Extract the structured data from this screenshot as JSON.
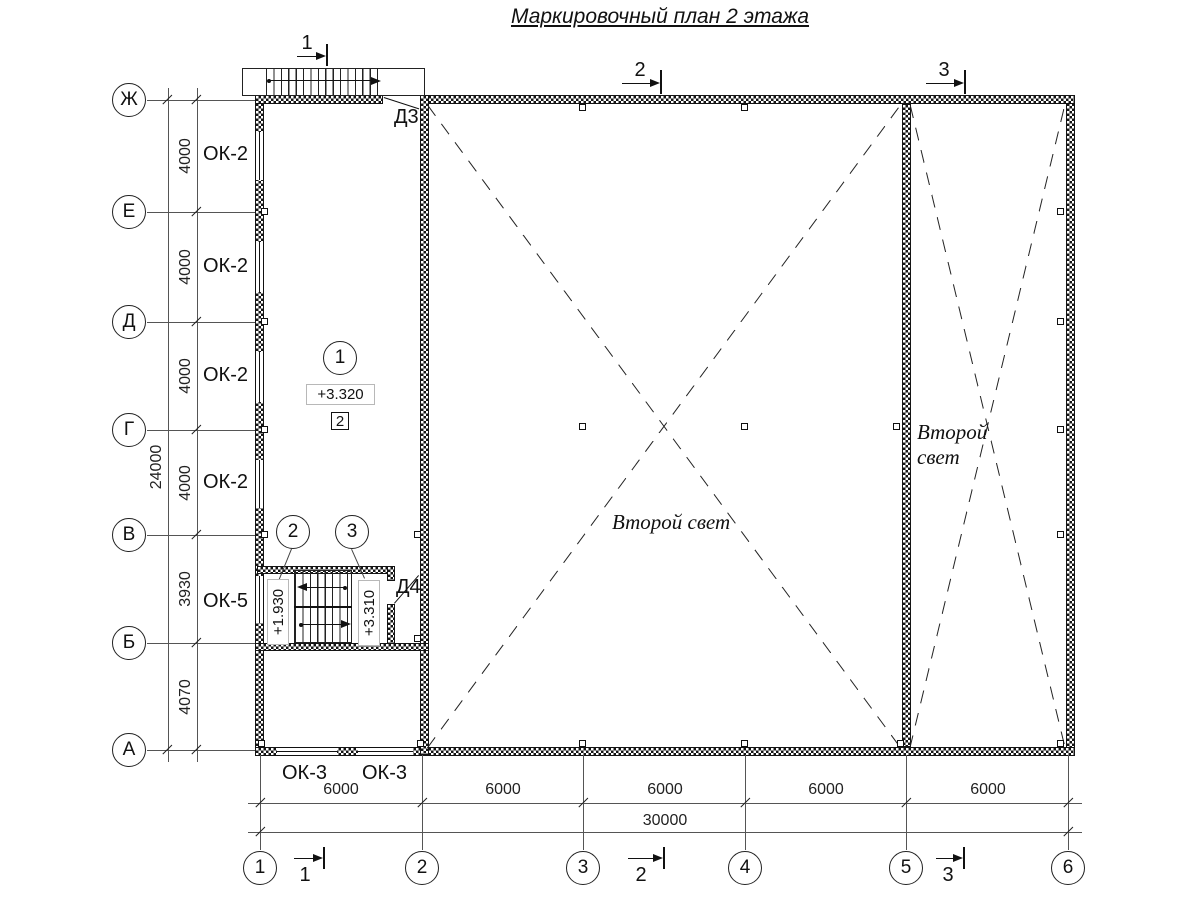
{
  "title": "Маркировочный план 2 этажа",
  "axes": {
    "rows": [
      "Ж",
      "Е",
      "Д",
      "Г",
      "В",
      "Б",
      "А"
    ],
    "cols": [
      "1",
      "2",
      "3",
      "4",
      "5",
      "6"
    ]
  },
  "dims": {
    "vertical": {
      "segments": [
        "4000",
        "4000",
        "4000",
        "4000",
        "3930",
        "4070"
      ],
      "overall": "24000"
    },
    "horizontal": {
      "segments": [
        "6000",
        "6000",
        "6000",
        "6000",
        "6000"
      ],
      "overall": "30000"
    }
  },
  "labels": {
    "window_ok2": "ОК-2",
    "window_ok5": "ОК-5",
    "window_ok3": "ОК-3",
    "door_d3": "Д3",
    "door_d4": "Д4",
    "level_main": "+3.320",
    "level_stair_lower": "+1.930",
    "level_stair_upper": "+3.310",
    "second_light": "Второй свет",
    "second_light_l1": "Второй",
    "second_light_l2": "свет"
  },
  "callouts": {
    "node1": "1",
    "node2": "2",
    "node3": "3",
    "square": "2"
  },
  "sections": {
    "s1": "1",
    "s2": "2",
    "s3": "3"
  }
}
